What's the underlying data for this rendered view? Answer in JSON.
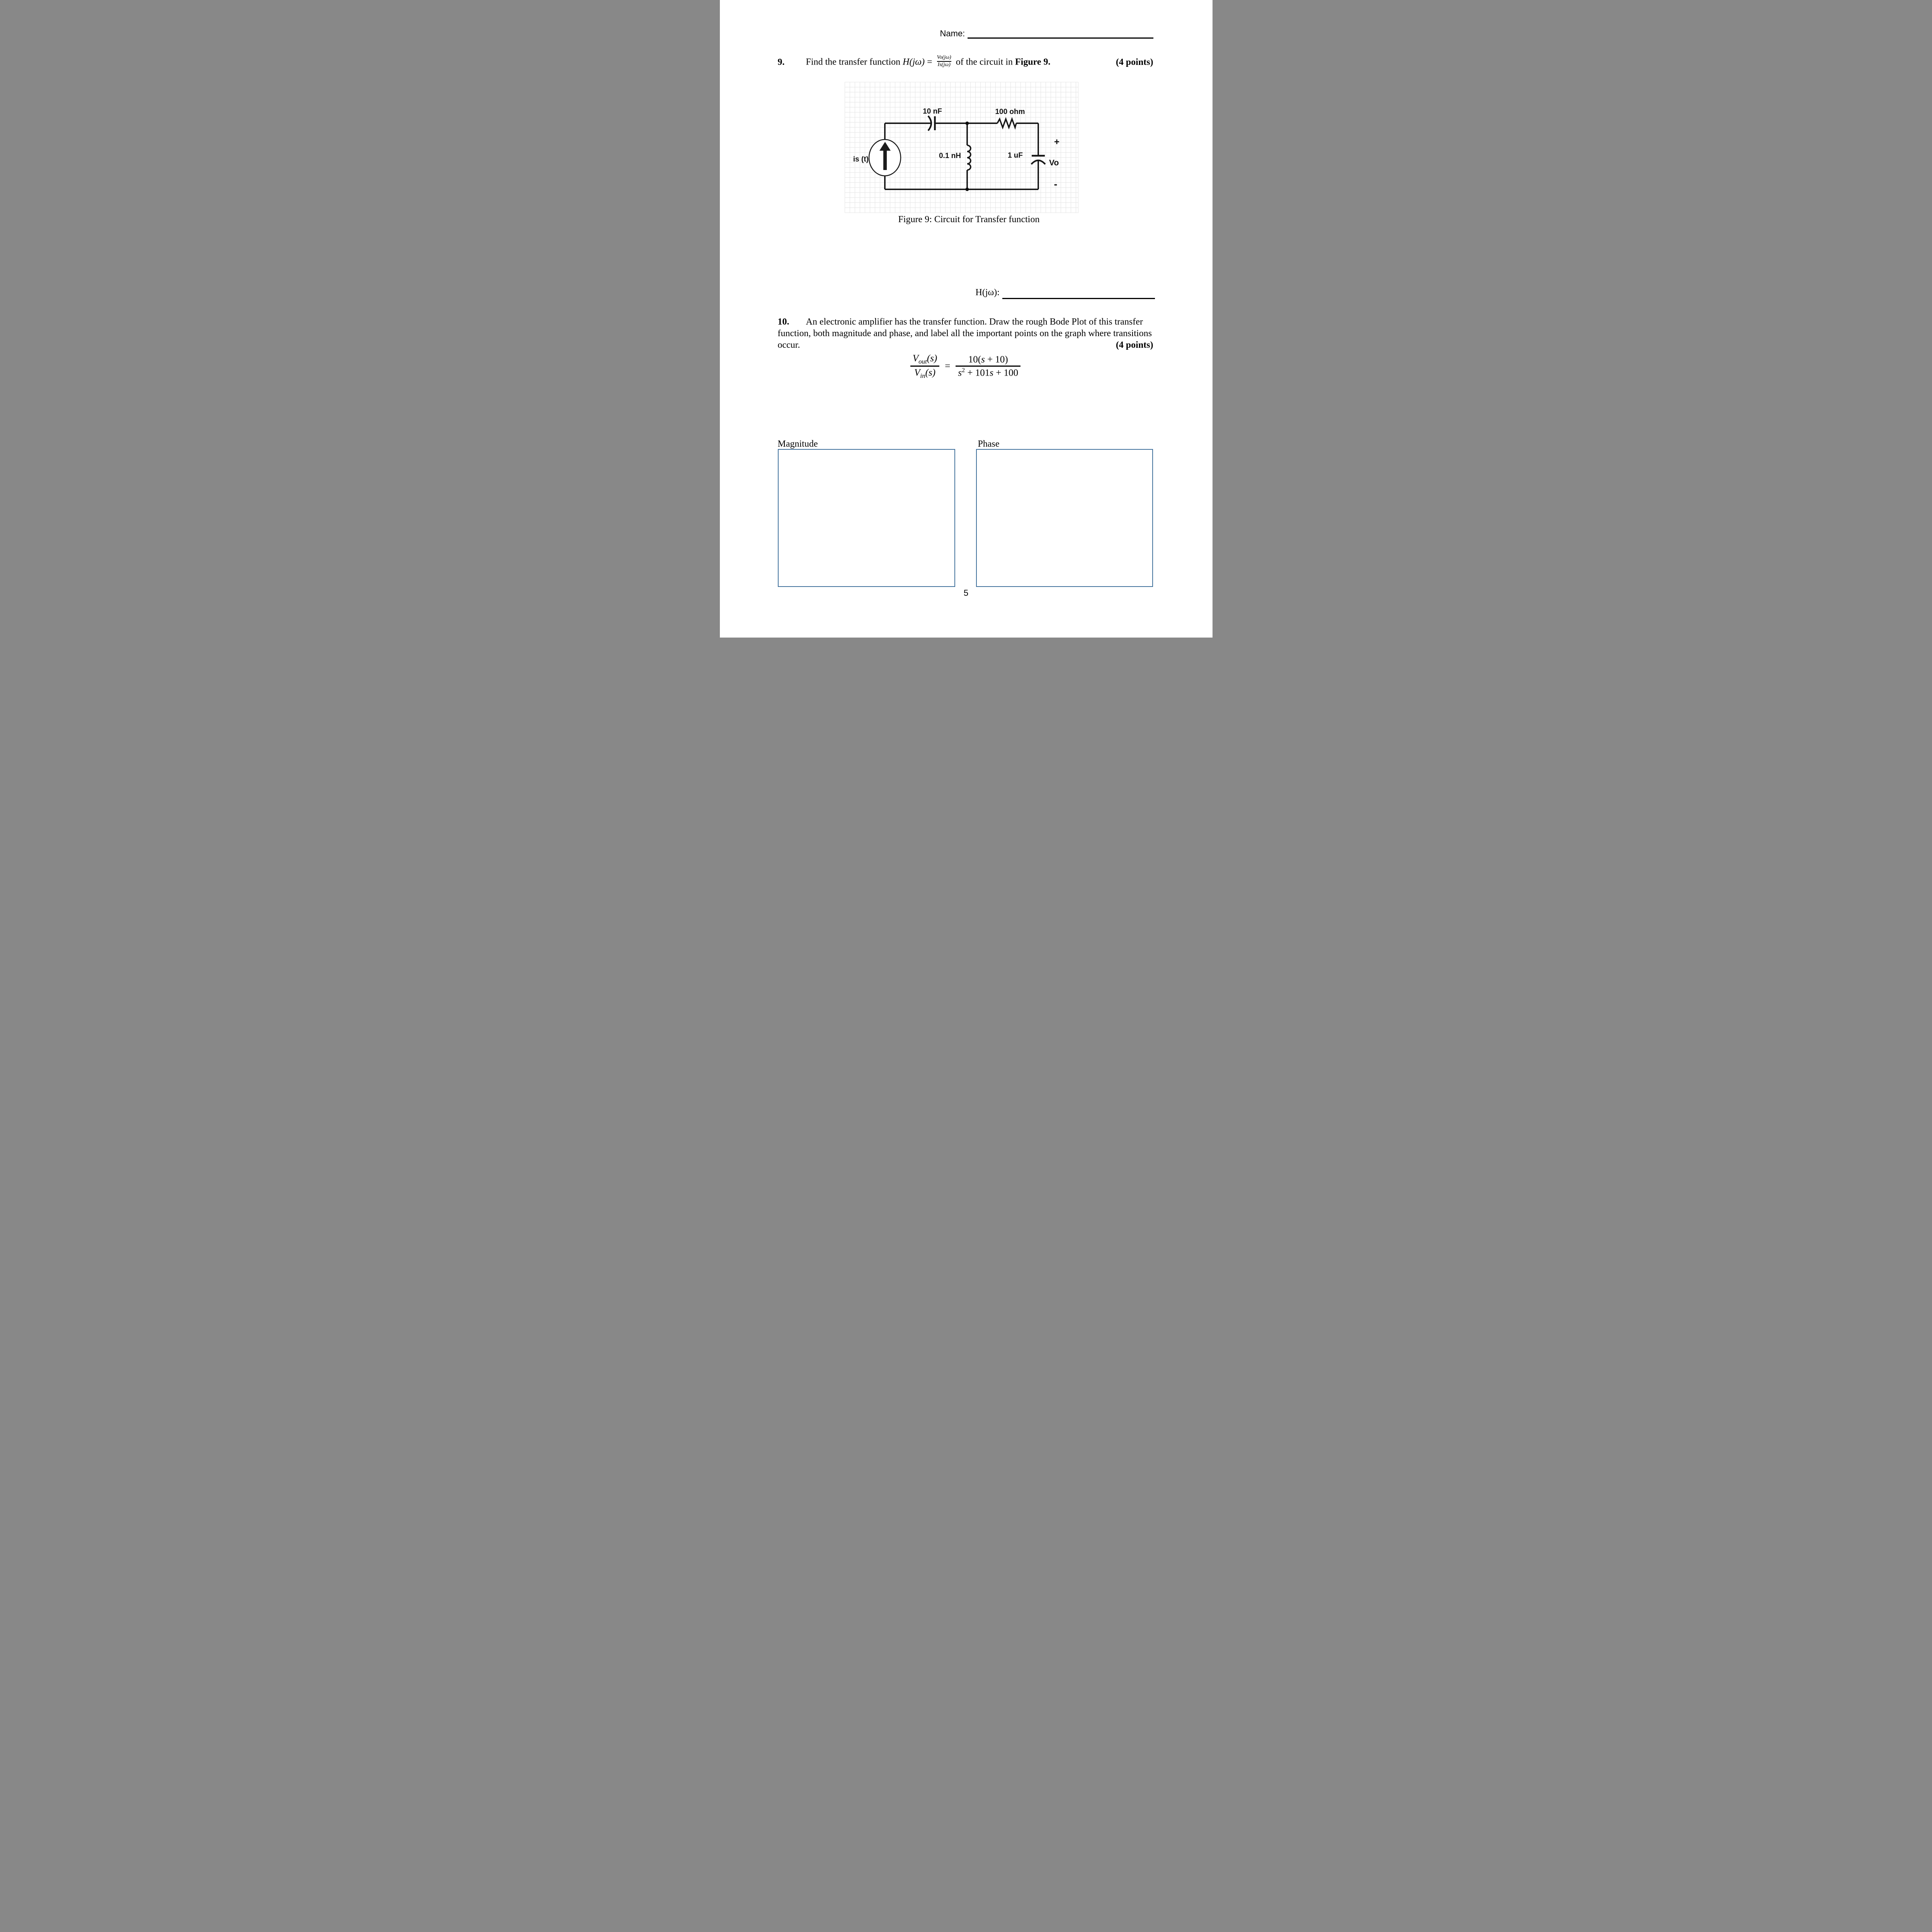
{
  "page": {
    "number": "5"
  },
  "colors": {
    "box_border": "#41719C",
    "grid_line": "#E4E4E4",
    "ink": "#000000"
  },
  "header": {
    "name_label": "Name:"
  },
  "q9": {
    "number": "9.",
    "prompt_start": "Find the transfer function ",
    "func_name": "H",
    "func_arg": "(jω)",
    "equals": " = ",
    "frac_num": "Vo(jω)",
    "frac_den": "Is(jω)",
    "prompt_mid": " of the circuit in ",
    "figure_ref": "Figure 9.",
    "points": "(4 points)"
  },
  "circuit": {
    "source_label": "is (t)",
    "cap1_label": "10 nF",
    "resistor_label": "100 ohm",
    "inductor_label": "0.1 nH",
    "cap2_label": "1 uF",
    "plus_label": "+",
    "output_label": "Vo",
    "minus_label": "-",
    "caption": "Figure 9: Circuit for Transfer function"
  },
  "answer": {
    "label": "H(jω):"
  },
  "q10": {
    "number": "10.",
    "line1": "An electronic amplifier has the transfer function. Draw the rough Bode Plot of this transfer",
    "line2": "function, both magnitude and phase, and label all the important points on the graph where transitions",
    "line3": "occur.",
    "points": "(4 points)",
    "eq": {
      "lhs_num_var": "V",
      "lhs_num_sub": "out",
      "lhs_num_arg": "(s)",
      "lhs_den_var": "V",
      "lhs_den_sub": "in",
      "lhs_den_arg": "(s)",
      "equals": "=",
      "rhs_num_pre": "10(",
      "rhs_num_var": "s",
      "rhs_num_post": " + 10)",
      "rhs_den_var1": "s",
      "rhs_den_sup": "2",
      "rhs_den_mid": " + 101",
      "rhs_den_var2": "s",
      "rhs_den_post": " + 100"
    }
  },
  "plots": {
    "magnitude_label": "Magnitude",
    "phase_label": "Phase"
  }
}
